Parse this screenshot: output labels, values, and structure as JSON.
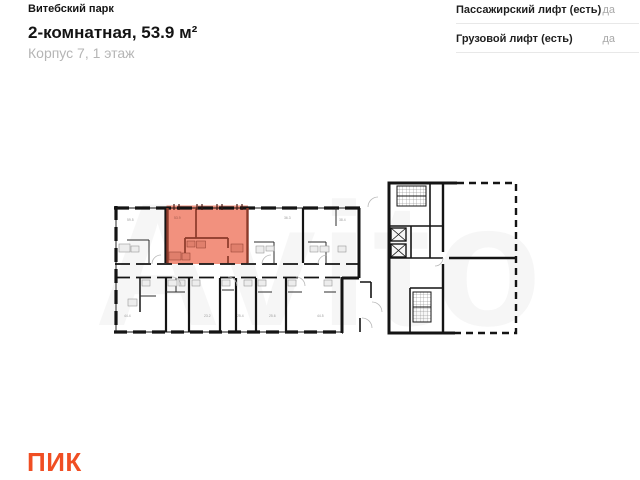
{
  "header": {
    "project": "Витебский парк",
    "title": "2-комнатная, 53.9 м²",
    "subtitle": "Корпус 7, 1 этаж"
  },
  "attributes": [
    {
      "label": "Пассажирский лифт (есть)",
      "value": "да"
    },
    {
      "label": "Грузовой лифт (есть)",
      "value": "да"
    }
  ],
  "floorplan": {
    "watermark": "Avito",
    "wall_color": "#141414",
    "highlight": {
      "label": "53.9",
      "fill": "#F2917E",
      "wall": "#8C3A2A"
    },
    "room_labels": [
      "59.5",
      "36.3",
      "38.4",
      "44.4",
      "23.2",
      "25.4",
      "25.6",
      "44.5"
    ]
  },
  "footer": {
    "logo": "ПИК",
    "logo_color": "#F04E23"
  }
}
